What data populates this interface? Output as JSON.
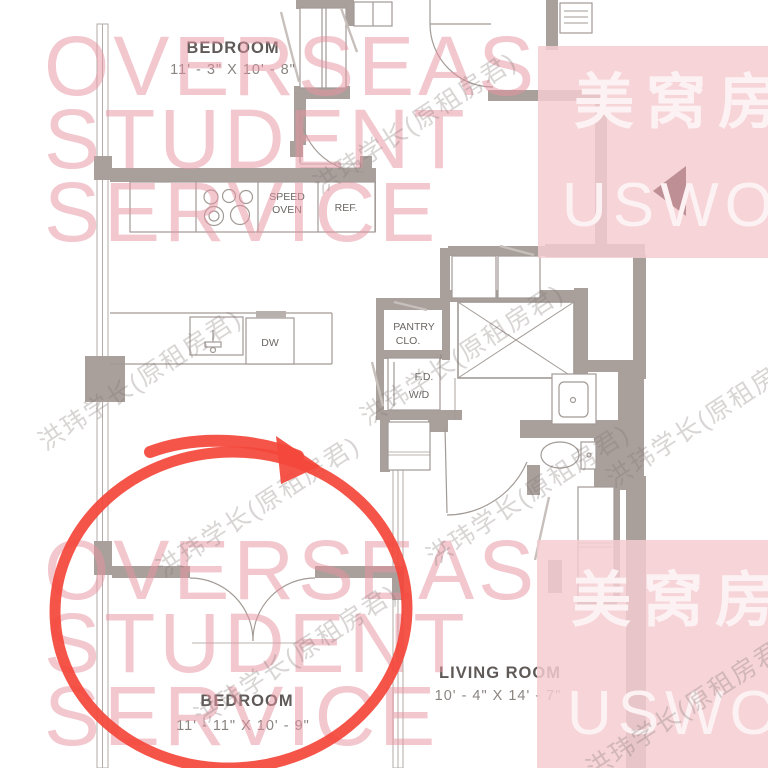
{
  "rooms": {
    "bedroom_top": {
      "name": "BEDROOM",
      "dims": "11' - 3\" X 10' - 8\""
    },
    "bedroom_bottom": {
      "name": "BEDROOM",
      "dims": "11' - 11\" X 10' - 9\""
    },
    "living_room": {
      "name": "LIVING ROOM",
      "dims": "10' - 4\" X 14' - 7\""
    }
  },
  "labels": {
    "speed_oven": [
      "SPEED",
      "OVEN"
    ],
    "refrigerator": "REF.",
    "dishwasher": "DW",
    "pantry_closet": [
      "PANTRY",
      "CLO."
    ],
    "floor_drain": "F.D.",
    "washer_dryer": "W/D"
  },
  "watermarks": {
    "agency": {
      "lines": [
        "OVERSEAS",
        "STUDENT",
        "SERVICE"
      ]
    },
    "brand": {
      "cn": "美窝房",
      "en": "USWO"
    },
    "diagonal": "洪玮学长(原租房君)"
  },
  "colors": {
    "wall": "#a9a09c",
    "agency_pink": "#e694a1",
    "block_pink": "#f4ccd1",
    "brand_white": "#fdf2f3",
    "annotation_red": "#f4473b"
  }
}
